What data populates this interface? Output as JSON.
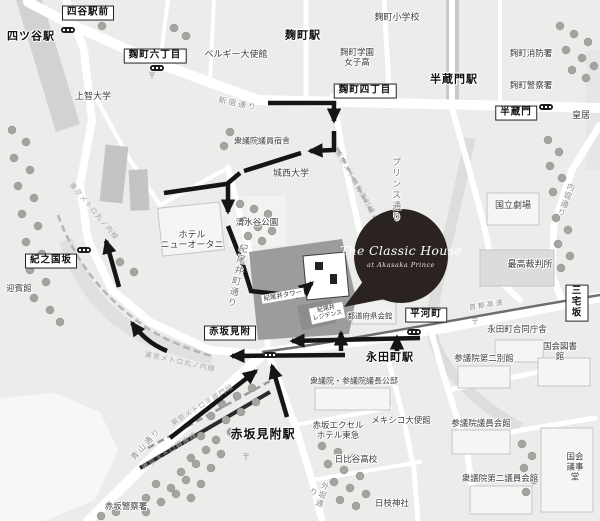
{
  "colors": {
    "bg": "#ececeb",
    "road": "#ffffff",
    "water": "#f7f7f5",
    "block-dark": "#9c9c9c",
    "building-dark": "#8d8d8d",
    "building": "#f5f5f4",
    "tree": "#a3a5a1",
    "rail": "#c9c9c9",
    "route": "#151515",
    "balloon": "#2b2320"
  },
  "balloon": {
    "title": "The Classic House",
    "subtitle": "at Akasaka Prince"
  },
  "map": {
    "labels": [
      {
        "t": "四谷駅前",
        "x": 88,
        "y": 13,
        "cls": "box"
      },
      {
        "t": "麹町六丁目",
        "x": 155,
        "y": 56,
        "cls": "box"
      },
      {
        "t": "麹町四丁目",
        "x": 365,
        "y": 91,
        "cls": "box"
      },
      {
        "t": "半蔵門",
        "x": 516,
        "y": 113,
        "cls": "box"
      },
      {
        "t": "紀之国坂",
        "x": 51,
        "y": 261,
        "cls": "box"
      },
      {
        "t": "赤坂見附",
        "x": 230,
        "y": 333,
        "cls": "box"
      },
      {
        "t": "平河町",
        "x": 426,
        "y": 315,
        "cls": "box"
      },
      {
        "t": "三宅坂",
        "x": 577,
        "y": 303,
        "cls": "box"
      },
      {
        "t": "四ツ谷駅",
        "x": 31,
        "y": 37,
        "cls": "bold"
      },
      {
        "t": "麹町駅",
        "x": 303,
        "y": 36,
        "cls": "bold"
      },
      {
        "t": "半蔵門駅",
        "x": 454,
        "y": 80,
        "cls": "bold"
      },
      {
        "t": "永田町駅",
        "x": 390,
        "y": 358,
        "cls": "bold"
      },
      {
        "t": "赤坂見附駅",
        "x": 263,
        "y": 435,
        "cls": "bold",
        "s": 12
      },
      {
        "t": "ベルギー大使館",
        "x": 236,
        "y": 54
      },
      {
        "t": "上智大学",
        "x": 93,
        "y": 96
      },
      {
        "t": "麹町小学校",
        "x": 397,
        "y": 17
      },
      {
        "t": "麹町学園\n女子高",
        "x": 357,
        "y": 58,
        "s": 8.5
      },
      {
        "t": "麹町消防署",
        "x": 531,
        "y": 54,
        "s": 8.5
      },
      {
        "t": "麹町警察署",
        "x": 531,
        "y": 86,
        "s": 8.5
      },
      {
        "t": "皇居",
        "x": 581,
        "y": 115
      },
      {
        "t": "衆議院議員宿舎",
        "x": 262,
        "y": 141,
        "s": 8
      },
      {
        "t": "城西大学",
        "x": 291,
        "y": 173
      },
      {
        "t": "清水谷公園",
        "x": 257,
        "y": 223,
        "s": 8.5
      },
      {
        "t": "ホテル\nニューオータニ",
        "x": 192,
        "y": 240
      },
      {
        "t": "迎賓館",
        "x": 19,
        "y": 289,
        "s": 8.5
      },
      {
        "t": "国立劇場",
        "x": 513,
        "y": 205
      },
      {
        "t": "最高裁判所",
        "x": 530,
        "y": 264
      },
      {
        "t": "都道府県会館",
        "x": 370,
        "y": 317,
        "s": 7.5
      },
      {
        "t": "永田町合同庁舎",
        "x": 517,
        "y": 330,
        "s": 8.5
      },
      {
        "t": "国会図書館",
        "x": 560,
        "y": 352,
        "s": 8.5
      },
      {
        "t": "参議院第二別館",
        "x": 484,
        "y": 359,
        "s": 8.5
      },
      {
        "t": "衆議院・参議院議長公邸",
        "x": 354,
        "y": 381,
        "s": 8
      },
      {
        "t": "メキシコ大使館",
        "x": 401,
        "y": 421,
        "s": 8.5
      },
      {
        "t": "赤坂エクセル\nホテル東急",
        "x": 338,
        "y": 431,
        "s": 8.5
      },
      {
        "t": "参議院議員会館",
        "x": 481,
        "y": 424,
        "s": 8.5
      },
      {
        "t": "日比谷高校",
        "x": 356,
        "y": 460,
        "s": 8.5
      },
      {
        "t": "日枝神社",
        "x": 392,
        "y": 504,
        "s": 8.5
      },
      {
        "t": "衆議院第二議員会館",
        "x": 500,
        "y": 479,
        "s": 8.5
      },
      {
        "t": "国会議事堂",
        "x": 575,
        "y": 467,
        "s": 8.5
      },
      {
        "t": "赤坂警察署",
        "x": 126,
        "y": 507,
        "s": 8.5
      },
      {
        "t": "新宿通り",
        "x": 238,
        "y": 104,
        "cls": "road",
        "r": 12
      },
      {
        "t": "青山通り",
        "x": 146,
        "y": 444,
        "cls": "road",
        "r": -48
      },
      {
        "t": "首都高速",
        "x": 487,
        "y": 306,
        "cls": "road",
        "r": -9,
        "s": 7
      },
      {
        "t": "外堀通り",
        "x": 318,
        "y": 493,
        "cls": "vroad",
        "r": 18
      },
      {
        "t": "内堀通り",
        "x": 566,
        "y": 200,
        "cls": "vroad",
        "r": 20
      },
      {
        "t": "プリンス通り",
        "x": 396,
        "y": 190,
        "cls": "v"
      },
      {
        "t": "紀尾井町通り",
        "x": 237,
        "y": 276,
        "cls": "v",
        "r": 12
      },
      {
        "t": "東京メトロ丸ノ内線",
        "x": 93,
        "y": 212,
        "cls": "transit",
        "r": 50
      },
      {
        "t": "東京メトロ丸ノ内線",
        "x": 180,
        "y": 363,
        "cls": "transit",
        "r": 12
      },
      {
        "t": "東京メトロ半蔵門線",
        "x": 203,
        "y": 406,
        "cls": "transit",
        "r": -32
      },
      {
        "t": "東京メトロ銀座線",
        "x": 170,
        "y": 452,
        "cls": "transit",
        "r": -32
      },
      {
        "t": "東京メトロ有楽町線",
        "x": 354,
        "y": 183,
        "cls": "transit",
        "r": 60
      },
      {
        "t": "紀尾井タワー",
        "x": 283,
        "y": 296,
        "cls": "tinyw",
        "r": -10
      },
      {
        "t": "紀尾井\nレジデンス",
        "x": 327,
        "y": 313,
        "cls": "tinyw",
        "r": -12,
        "s": 6
      },
      {
        "t": "〒",
        "x": 152,
        "y": 76,
        "cls": "sym"
      },
      {
        "t": "〒",
        "x": 246,
        "y": 457,
        "cls": "sym"
      },
      {
        "t": "〒",
        "x": 475,
        "y": 322,
        "cls": "sym"
      }
    ],
    "station_entrances": [
      {
        "x": 68,
        "y": 30
      },
      {
        "x": 157,
        "y": 68
      },
      {
        "x": 546,
        "y": 107
      },
      {
        "x": 84,
        "y": 250
      },
      {
        "x": 270,
        "y": 355
      },
      {
        "x": 414,
        "y": 332
      }
    ]
  }
}
